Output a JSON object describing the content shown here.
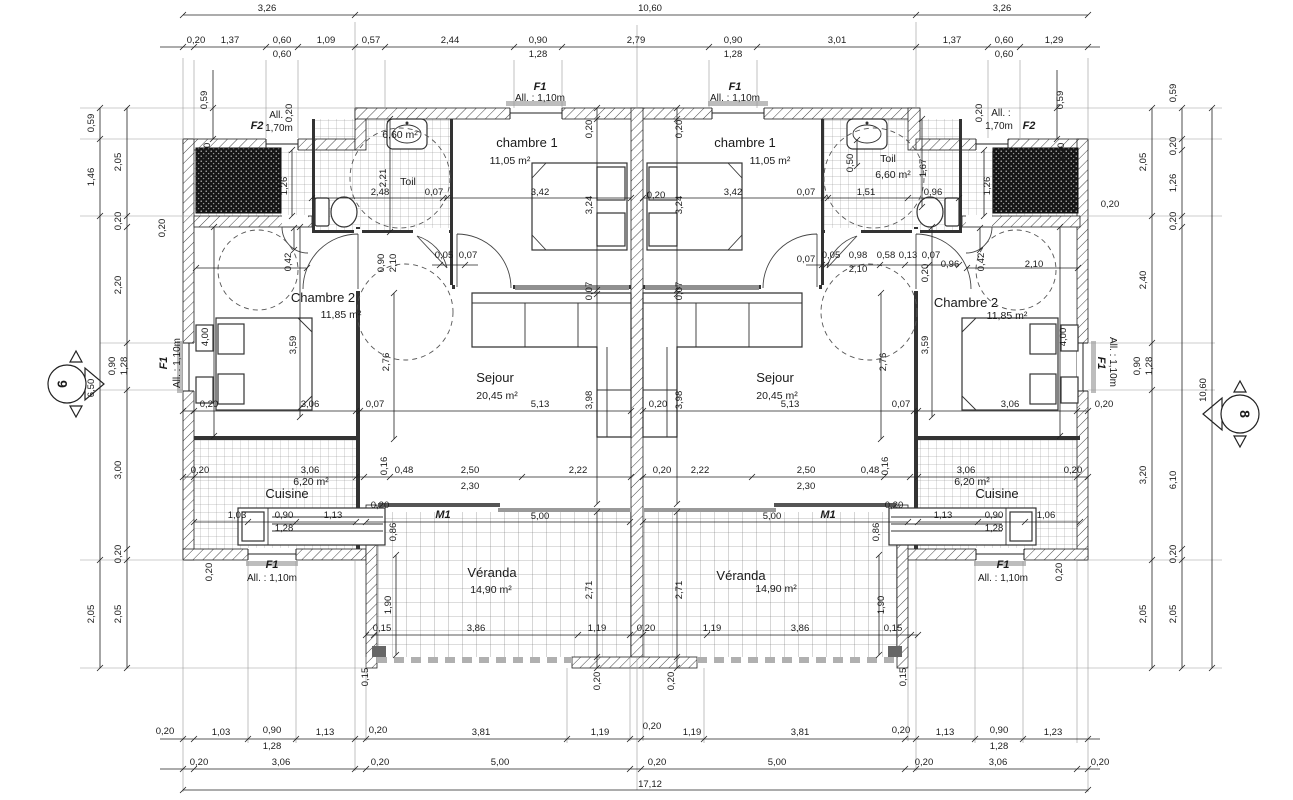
{
  "drawing": {
    "type": "architectural floor plan, mirrored duplex",
    "overall_width_m": "17,12",
    "overall_depth_m": "10,60",
    "units": 2
  },
  "rooms": [
    {
      "name": "chambre 1",
      "area": "11,05 m²"
    },
    {
      "name": "Chambre 2",
      "area": "11,85 m²"
    },
    {
      "name": "Sejour",
      "area": "20,45 m²"
    },
    {
      "name": "Cuisine",
      "area": "6,20 m²"
    },
    {
      "name": "Toil",
      "area": "6,60 m²"
    },
    {
      "name": "Véranda",
      "area": "14,90 m²"
    }
  ],
  "openings": [
    {
      "code": "F1",
      "allege": "All. : 1,10m"
    },
    {
      "code": "F2",
      "allege": "All. : 1,70m"
    },
    {
      "code": "M1",
      "allege": ""
    }
  ],
  "section_markers": [
    "6",
    "8"
  ],
  "labels": [
    [
      "3,26",
      267,
      11
    ],
    [
      "10,60",
      650,
      11
    ],
    [
      "3,26",
      1002,
      11
    ],
    [
      "0,20",
      196,
      43
    ],
    [
      "1,37",
      230,
      43
    ],
    [
      "0,60",
      282,
      43
    ],
    [
      "0,60",
      282,
      57
    ],
    [
      "1,09",
      326,
      43
    ],
    [
      "0,57",
      371,
      43
    ],
    [
      "2,44",
      450,
      43
    ],
    [
      "0,90",
      538,
      43
    ],
    [
      "1,28",
      538,
      57
    ],
    [
      "2,79",
      636,
      43
    ],
    [
      "0,90",
      733,
      43
    ],
    [
      "1,28",
      733,
      57
    ],
    [
      "3,01",
      837,
      43
    ],
    [
      "1,37",
      952,
      43
    ],
    [
      "0,60",
      1004,
      43
    ],
    [
      "0,60",
      1004,
      57
    ],
    [
      "1,29",
      1054,
      43
    ],
    [
      "0,20",
      165,
      734
    ],
    [
      "1,03",
      221,
      735
    ],
    [
      "0,90",
      272,
      733
    ],
    [
      "1,28",
      272,
      749
    ],
    [
      "1,13",
      325,
      735
    ],
    [
      "0,20",
      378,
      733
    ],
    [
      "3,81",
      481,
      735
    ],
    [
      "1,19",
      600,
      735
    ],
    [
      "0,20",
      652,
      729
    ],
    [
      "1,19",
      692,
      735
    ],
    [
      "3,81",
      800,
      735
    ],
    [
      "0,20",
      901,
      733
    ],
    [
      "1,13",
      945,
      735
    ],
    [
      "0,90",
      999,
      733
    ],
    [
      "1,28",
      999,
      749
    ],
    [
      "1,23",
      1053,
      735
    ],
    [
      "0,20",
      199,
      765
    ],
    [
      "3,06",
      281,
      765
    ],
    [
      "0,20",
      380,
      765
    ],
    [
      "5,00",
      500,
      765
    ],
    [
      "0,20",
      657,
      765
    ],
    [
      "5,00",
      777,
      765
    ],
    [
      "0,20",
      924,
      765
    ],
    [
      "3,06",
      998,
      765
    ],
    [
      "0,20",
      1100,
      765
    ],
    [
      "17,12",
      650,
      787
    ],
    [
      "0,59",
      94,
      123,
      "d",
      1
    ],
    [
      "1,46",
      94,
      177,
      "d",
      1
    ],
    [
      "6,50",
      94,
      388,
      "d",
      1
    ],
    [
      "2,05",
      94,
      614,
      "d",
      1
    ],
    [
      "2,05",
      121,
      162,
      "d",
      1
    ],
    [
      "0,20",
      121,
      221,
      "d",
      1
    ],
    [
      "2,20",
      121,
      285,
      "d",
      1
    ],
    [
      "0,90",
      115,
      366,
      "d",
      1
    ],
    [
      "1,28",
      127,
      366,
      "d",
      1
    ],
    [
      "3,00",
      121,
      470,
      "d",
      1
    ],
    [
      "0,20",
      121,
      554,
      "d",
      1
    ],
    [
      "2,05",
      121,
      614,
      "d",
      1
    ],
    [
      "0,59",
      207,
      100,
      "d",
      1
    ],
    [
      "0,59",
      1063,
      100,
      "d",
      1
    ],
    [
      "2,05",
      1146,
      162,
      "d",
      1
    ],
    [
      "2,40",
      1146,
      280,
      "d",
      1
    ],
    [
      "0,90",
      1140,
      366,
      "d",
      1
    ],
    [
      "1,28",
      1152,
      366,
      "d",
      1
    ],
    [
      "3,20",
      1146,
      475,
      "d",
      1
    ],
    [
      "2,05",
      1146,
      614,
      "d",
      1
    ],
    [
      "0,59",
      1176,
      93,
      "d",
      1
    ],
    [
      "0,20",
      1176,
      146,
      "d",
      1
    ],
    [
      "1,26",
      1176,
      183,
      "d",
      1
    ],
    [
      "0,20",
      1176,
      221,
      "d",
      1
    ],
    [
      "6,10",
      1176,
      480,
      "d",
      1
    ],
    [
      "0,20",
      1176,
      554,
      "d",
      1
    ],
    [
      "2,05",
      1176,
      614,
      "d",
      1
    ],
    [
      "10,60",
      1206,
      390,
      "d",
      1
    ],
    [
      "chambre 1",
      527,
      147,
      "r"
    ],
    [
      "11,05 m²",
      510,
      164,
      "a"
    ],
    [
      "Chambre 2",
      323,
      302,
      "r"
    ],
    [
      "11,85 m²",
      341,
      318,
      "a"
    ],
    [
      "Sejour",
      495,
      382,
      "r"
    ],
    [
      "20,45 m²",
      497,
      399,
      "a"
    ],
    [
      "6,20 m²",
      311,
      485,
      "a"
    ],
    [
      "Cuisine",
      287,
      498,
      "r"
    ],
    [
      "Toil",
      408,
      185,
      "a"
    ],
    [
      "6,60 m²",
      400,
      138,
      "a"
    ],
    [
      "Véranda",
      492,
      577,
      "r"
    ],
    [
      "14,90 m²",
      491,
      593,
      "a"
    ],
    [
      "chambre 1",
      745,
      147,
      "r"
    ],
    [
      "11,05 m²",
      770,
      164,
      "a"
    ],
    [
      "Chambre 2",
      966,
      307,
      "r"
    ],
    [
      "11,85 m²",
      1007,
      319,
      "a"
    ],
    [
      "Sejour",
      775,
      382,
      "r"
    ],
    [
      "20,45 m²",
      777,
      399,
      "a"
    ],
    [
      "6,20 m²",
      972,
      485,
      "a"
    ],
    [
      "Cuisine",
      997,
      498,
      "r"
    ],
    [
      "Toil",
      888,
      162,
      "a"
    ],
    [
      "6,60 m²",
      893,
      178,
      "a"
    ],
    [
      "Véranda",
      741,
      580,
      "r"
    ],
    [
      "14,90 m²",
      776,
      592,
      "a"
    ],
    [
      "F1",
      540,
      90,
      "w"
    ],
    [
      "All. : 1,10m",
      540,
      101,
      "n"
    ],
    [
      "F1",
      735,
      90,
      "w"
    ],
    [
      "All. : 1,10m",
      735,
      101,
      "n"
    ],
    [
      "F2",
      257,
      129,
      "w"
    ],
    [
      "All. :",
      279,
      118,
      "n"
    ],
    [
      "1,70m",
      279,
      131,
      "n"
    ],
    [
      "All. :",
      1001,
      116,
      "n"
    ],
    [
      "1,70m",
      999,
      129,
      "n"
    ],
    [
      "F2",
      1029,
      129,
      "w"
    ],
    [
      "F1",
      167,
      363,
      "w",
      1
    ],
    [
      "All. : 1,10m",
      180,
      363,
      "n",
      1
    ],
    [
      "F1",
      1098,
      363,
      "w",
      2
    ],
    [
      "All. : 1,10m",
      1110,
      362,
      "n",
      2
    ],
    [
      "F1",
      272,
      568,
      "w"
    ],
    [
      "All. : 1,10m",
      272,
      581,
      "n"
    ],
    [
      "F1",
      1003,
      568,
      "w"
    ],
    [
      "All. : 1,10m",
      1003,
      581,
      "n"
    ],
    [
      "M1",
      443,
      518,
      "w"
    ],
    [
      "M1",
      828,
      518,
      "w"
    ],
    [
      "6",
      67,
      384,
      "m",
      1
    ],
    [
      "8",
      1240,
      414,
      "m",
      2
    ],
    [
      "2,48",
      380,
      195
    ],
    [
      "0,07",
      434,
      195
    ],
    [
      "3,42",
      540,
      195
    ],
    [
      "0,20",
      592,
      129,
      "d",
      1
    ],
    [
      "3,24",
      592,
      205,
      "d",
      1
    ],
    [
      "0,07",
      592,
      291,
      "d",
      1
    ],
    [
      "3,98",
      592,
      400,
      "d",
      1
    ],
    [
      "2,71",
      592,
      590,
      "d",
      1
    ],
    [
      "0,20",
      600,
      681,
      "d",
      1
    ],
    [
      "1,26",
      287,
      186,
      "d",
      1
    ],
    [
      "0,20",
      292,
      113,
      "d",
      1
    ],
    [
      "0,20",
      210,
      152,
      "d",
      1
    ],
    [
      "0,20",
      165,
      228,
      "d",
      1
    ],
    [
      "2,21",
      386,
      178,
      "d",
      1
    ],
    [
      "0,90",
      384,
      263,
      "d",
      1
    ],
    [
      "2,10",
      396,
      263,
      "d",
      1
    ],
    [
      "0,05",
      444,
      258
    ],
    [
      "0,07",
      468,
      258
    ],
    [
      "0,42",
      291,
      262,
      "d",
      1
    ],
    [
      "3,59",
      296,
      345,
      "d",
      1
    ],
    [
      "4,00",
      208,
      337,
      "d",
      1
    ],
    [
      "2,76",
      389,
      362,
      "d",
      1
    ],
    [
      "0,20",
      656,
      198
    ],
    [
      "3,42",
      733,
      195
    ],
    [
      "0,07",
      806,
      195
    ],
    [
      "1,51",
      866,
      195
    ],
    [
      "0,96",
      933,
      195
    ],
    [
      "0,20",
      682,
      129,
      "d",
      1
    ],
    [
      "3,24",
      682,
      205,
      "d",
      1
    ],
    [
      "0,07",
      682,
      291,
      "d",
      1
    ],
    [
      "3,98",
      682,
      400,
      "d",
      1
    ],
    [
      "2,71",
      682,
      590,
      "d",
      1
    ],
    [
      "0,20",
      674,
      681,
      "d",
      1
    ],
    [
      "1,26",
      990,
      186,
      "d",
      1
    ],
    [
      "0,20",
      982,
      113,
      "d",
      1
    ],
    [
      "0,20",
      1064,
      152,
      "d",
      1
    ],
    [
      "0,20",
      1110,
      207
    ],
    [
      "1,67",
      926,
      168,
      "d",
      1
    ],
    [
      "0,50",
      853,
      163,
      "d",
      1
    ],
    [
      "0,07",
      806,
      262
    ],
    [
      "0,05",
      831,
      258
    ],
    [
      "0,98",
      858,
      258
    ],
    [
      "2,10",
      858,
      272
    ],
    [
      "0,58",
      886,
      258
    ],
    [
      "0,13",
      908,
      258
    ],
    [
      "0,07",
      931,
      258
    ],
    [
      "0,96",
      950,
      267
    ],
    [
      "0,20",
      928,
      273,
      "d",
      1
    ],
    [
      "0,42",
      984,
      262,
      "d",
      1
    ],
    [
      "2,10",
      1034,
      267
    ],
    [
      "3,59",
      928,
      345,
      "d",
      1
    ],
    [
      "4,00",
      1066,
      337,
      "d",
      1
    ],
    [
      "2,76",
      886,
      362,
      "d",
      1
    ],
    [
      "0,20",
      209,
      407
    ],
    [
      "3,06",
      310,
      407
    ],
    [
      "0,07",
      375,
      407
    ],
    [
      "5,13",
      540,
      407
    ],
    [
      "0,20",
      658,
      407
    ],
    [
      "5,13",
      790,
      407
    ],
    [
      "0,07",
      901,
      407
    ],
    [
      "3,06",
      1010,
      407
    ],
    [
      "0,20",
      1104,
      407
    ],
    [
      "0,20",
      200,
      473
    ],
    [
      "3,06",
      310,
      473
    ],
    [
      "0,16",
      387,
      466,
      "d",
      1
    ],
    [
      "0,48",
      404,
      473
    ],
    [
      "2,50",
      470,
      473
    ],
    [
      "2,30",
      470,
      489
    ],
    [
      "2,22",
      578,
      473
    ],
    [
      "0,20",
      662,
      473
    ],
    [
      "2,22",
      700,
      473
    ],
    [
      "2,50",
      806,
      473
    ],
    [
      "2,30",
      806,
      489
    ],
    [
      "0,48",
      870,
      473
    ],
    [
      "0,16",
      888,
      466,
      "d",
      1
    ],
    [
      "3,06",
      966,
      473
    ],
    [
      "0,20",
      1073,
      473
    ],
    [
      "1,03",
      237,
      518
    ],
    [
      "0,90",
      284,
      518
    ],
    [
      "1,28",
      284,
      531
    ],
    [
      "1,13",
      333,
      518
    ],
    [
      "0,20",
      380,
      508
    ],
    [
      "0,86",
      396,
      532,
      "d",
      1
    ],
    [
      "0,20",
      212,
      572,
      "d",
      1
    ],
    [
      "1,13",
      943,
      518
    ],
    [
      "0,90",
      994,
      518
    ],
    [
      "1,28",
      994,
      531
    ],
    [
      "1,06",
      1046,
      518
    ],
    [
      "0,20",
      894,
      508
    ],
    [
      "0,86",
      879,
      532,
      "d",
      1
    ],
    [
      "0,20",
      1062,
      572,
      "d",
      1
    ],
    [
      "5,00",
      540,
      519
    ],
    [
      "5,00",
      772,
      519
    ],
    [
      "1,90",
      391,
      605,
      "d",
      1
    ],
    [
      "1,90",
      884,
      605,
      "d",
      1
    ],
    [
      "0,15",
      382,
      631
    ],
    [
      "3,86",
      476,
      631
    ],
    [
      "1,19",
      597,
      631
    ],
    [
      "0,20",
      646,
      631
    ],
    [
      "1,19",
      712,
      631
    ],
    [
      "3,86",
      800,
      631
    ],
    [
      "0,15",
      893,
      631
    ],
    [
      "0,15",
      368,
      677,
      "d",
      1
    ],
    [
      "0,15",
      906,
      677,
      "d",
      1
    ]
  ]
}
